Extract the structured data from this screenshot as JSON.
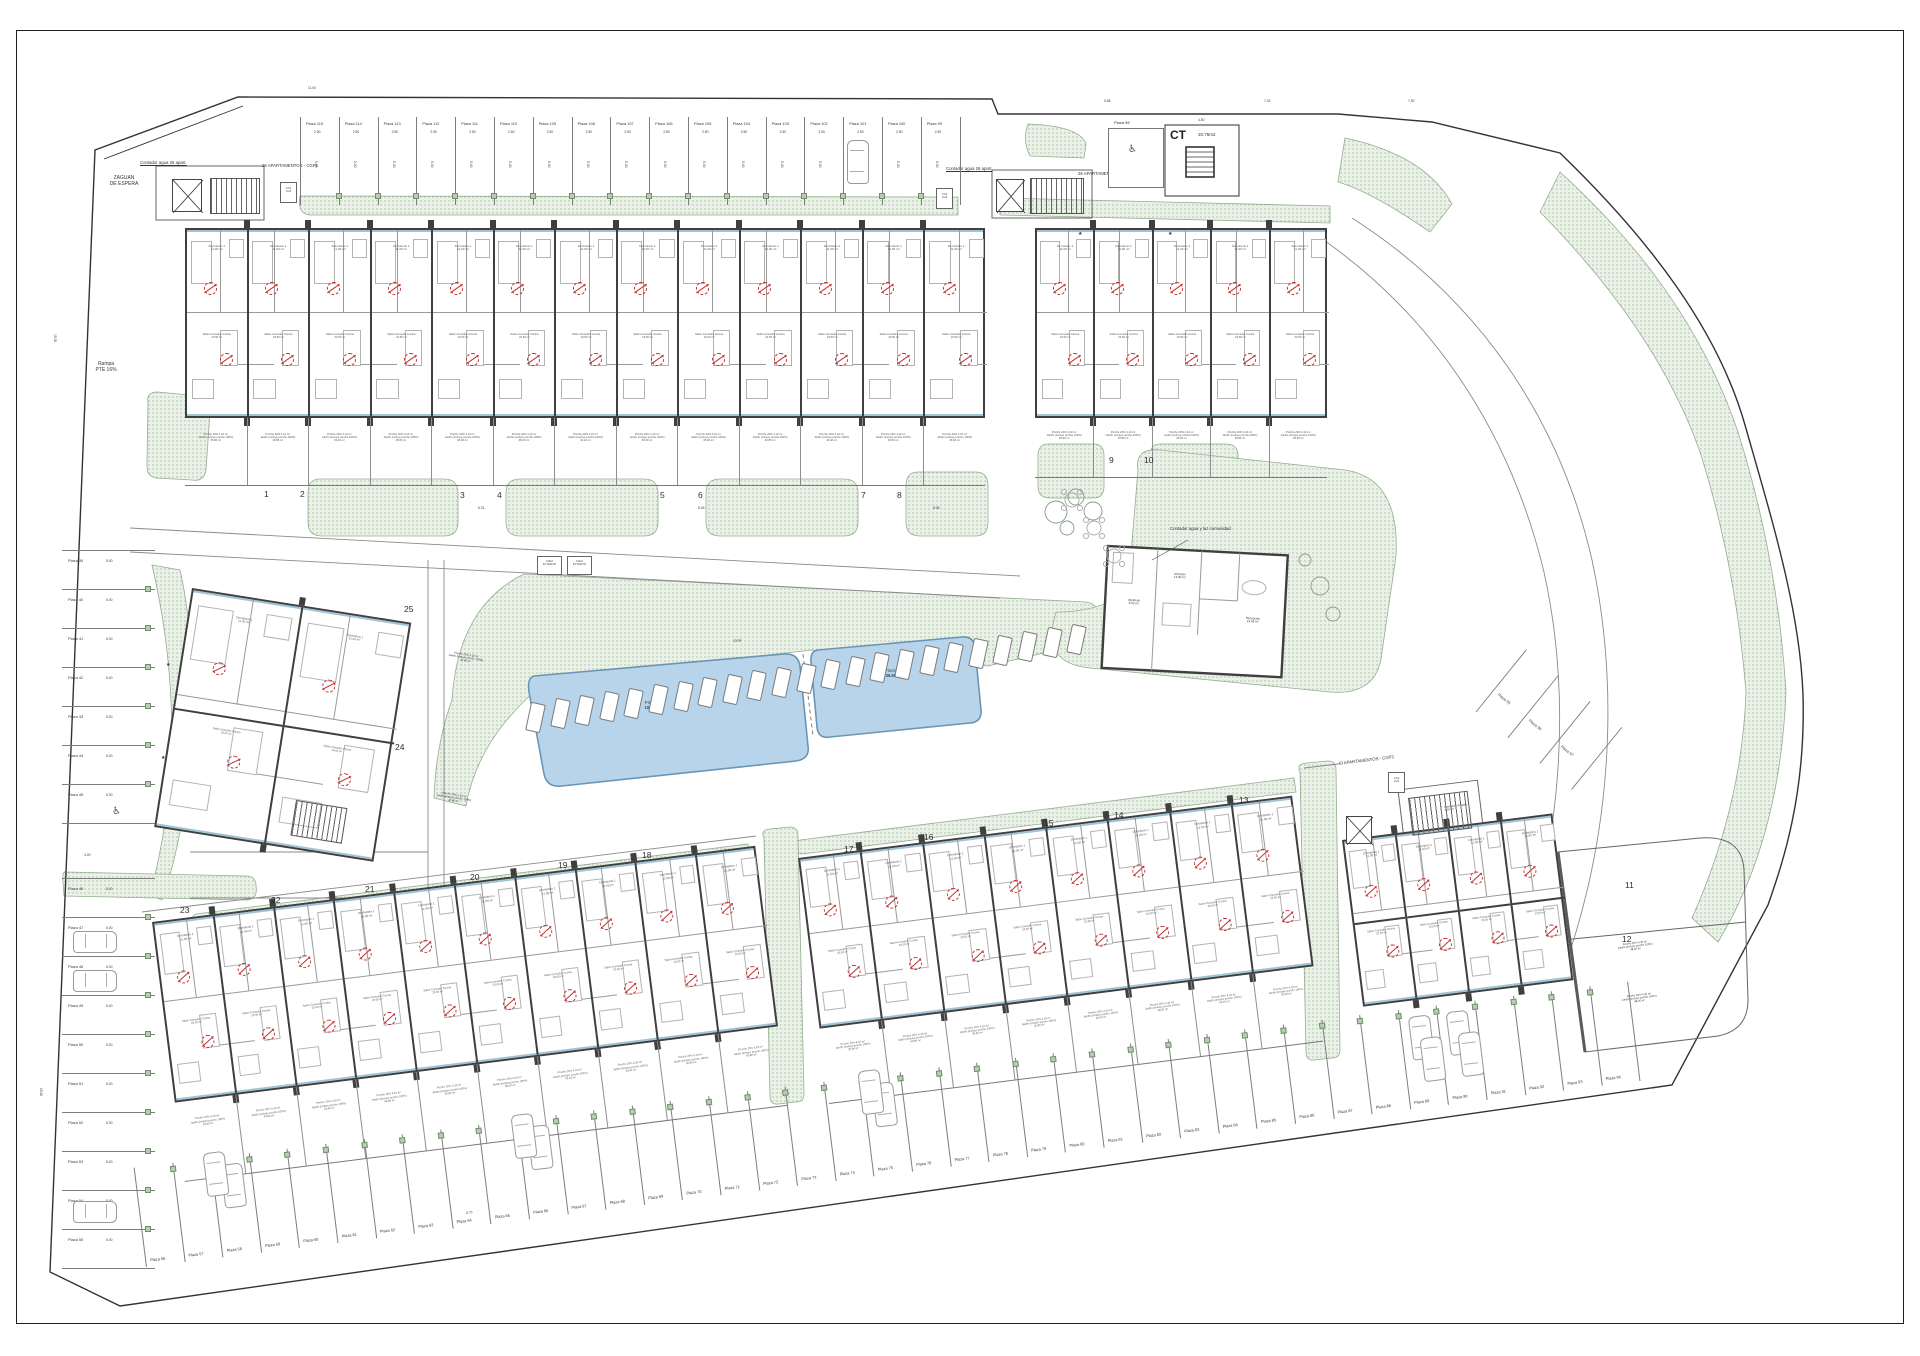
{
  "texts": {
    "zaguan": "ZAGUAN\nDE ESPERA",
    "rampa": "Rampa\nPTE 16%",
    "contador26_left": "Contador agua 26 apart.",
    "cgp1": "26 APARTAMENTOS - CGP1",
    "contador26_right": "Contador agua 26 apart.",
    "cgp2": "26 APARTAMENTOS - CGP2",
    "cgp3": "40 APARTAMENTOS - CGP3",
    "contador75": "Contador agua 75 apart.",
    "contador_comunidad": "Contador agua y luz comunidad",
    "contador75_room": "Contador 75 apart.\n3.00 m²",
    "ct": "CT",
    "ct_area": "20.75m2",
    "cc1": "CC1\nLUZ",
    "cc2": "CC2\nLUZ",
    "cc3": "CC3\nLUZ",
    "aseo": "ASEO\nEXTERIOR",
    "plaza98": "Plaza 98",
    "plaza98_dim": "3.81"
  },
  "pools": [
    {
      "name": "Piscina 1",
      "area": "100.30 m²"
    },
    {
      "name": "Piscina 2",
      "area": "36.90 m²"
    }
  ],
  "rooms": {
    "dorm1": "Dormitorio 1\n11.00 m²",
    "dorm2": "Dormitorio 2\n10.70 m²",
    "dorm3": "Dormitorio 3\n8.00 m²",
    "paso": "Paso\n4.60 m²",
    "bano1": "Baño 1\n3.90 m²",
    "bano2": "Baño 2\n3.00 m²",
    "salon": "Salón-Comedor-Cocina\n23.50 m²"
  },
  "community_rooms": [
    "Vestíbulo\n8.50 m²",
    "Almacén\n13.80 m²",
    "Recepción\n23.65 m²"
  ],
  "garden": {
    "porche": "Porche 20% 4.10 m²",
    "jardin": "Jardín (incluye porche 100%)",
    "areas": [
      "35.90 m²",
      "40.85 m²",
      "43.40 m²",
      "45.80 m²",
      "36.90 m²",
      "48.20 m²",
      "42.10 m²",
      "39.60 m²"
    ]
  },
  "parking": {
    "stall_width_dim": "2.50",
    "stall_depth_dim": "5.00",
    "top": [
      "Plaza 115",
      "Plaza 114",
      "Plaza 113",
      "Plaza 112",
      "Plaza 111",
      "Plaza 110",
      "Plaza 109",
      "Plaza 108",
      "Plaza 107",
      "Plaza 106",
      "Plaza 105",
      "Plaza 104",
      "Plaza 103",
      "Plaza 102",
      "Plaza 101",
      "Plaza 100",
      "Plaza 99"
    ],
    "left": [
      "Plaza 39",
      "Plaza 40",
      "Plaza 41",
      "Plaza 42",
      "Plaza 43",
      "Plaza 44",
      "Plaza 45",
      "Plaza 46",
      "Plaza 47",
      "Plaza 48",
      "Plaza 49",
      "Plaza 50",
      "Plaza 51",
      "Plaza 52",
      "Plaza 53",
      "Plaza 54",
      "Plaza 55"
    ],
    "bottom": [
      "Plaza 56",
      "Plaza 57",
      "Plaza 58",
      "Plaza 59",
      "Plaza 60",
      "Plaza 61",
      "Plaza 62",
      "Plaza 63",
      "Plaza 64",
      "Plaza 65",
      "Plaza 66",
      "Plaza 67",
      "Plaza 68",
      "Plaza 69",
      "Plaza 70",
      "Plaza 71",
      "Plaza 72",
      "Plaza 73",
      "Plaza 74",
      "Plaza 75",
      "Plaza 76",
      "Plaza 77",
      "Plaza 78",
      "Plaza 79",
      "Plaza 80",
      "Plaza 81",
      "Plaza 82",
      "Plaza 83",
      "Plaza 84",
      "Plaza 85",
      "Plaza 86",
      "Plaza 87",
      "Plaza 88",
      "Plaza 89",
      "Plaza 90",
      "Plaza 91",
      "Plaza 92",
      "Plaza 93",
      "Plaza 94"
    ],
    "diagonal": [
      "Plaza 95",
      "Plaza 96",
      "Plaza 97"
    ]
  },
  "block_numbers": [
    {
      "n": "1",
      "x": 264,
      "y": 489
    },
    {
      "n": "2",
      "x": 300,
      "y": 489
    },
    {
      "n": "3",
      "x": 460,
      "y": 490
    },
    {
      "n": "4",
      "x": 497,
      "y": 490
    },
    {
      "n": "5",
      "x": 660,
      "y": 490
    },
    {
      "n": "6",
      "x": 698,
      "y": 490
    },
    {
      "n": "7",
      "x": 861,
      "y": 490
    },
    {
      "n": "8",
      "x": 897,
      "y": 490
    },
    {
      "n": "9",
      "x": 1109,
      "y": 455
    },
    {
      "n": "10",
      "x": 1144,
      "y": 455
    },
    {
      "n": "11",
      "x": 1625,
      "y": 880
    },
    {
      "n": "12",
      "x": 1622,
      "y": 934
    },
    {
      "n": "13",
      "x": 1239,
      "y": 795
    },
    {
      "n": "14",
      "x": 1114,
      "y": 810
    },
    {
      "n": "15",
      "x": 1044,
      "y": 818
    },
    {
      "n": "16",
      "x": 924,
      "y": 832
    },
    {
      "n": "17",
      "x": 844,
      "y": 844
    },
    {
      "n": "18",
      "x": 642,
      "y": 850
    },
    {
      "n": "19",
      "x": 558,
      "y": 860
    },
    {
      "n": "20",
      "x": 470,
      "y": 872
    },
    {
      "n": "21",
      "x": 365,
      "y": 884
    },
    {
      "n": "22",
      "x": 271,
      "y": 895
    },
    {
      "n": "23",
      "x": 180,
      "y": 905
    },
    {
      "n": "24",
      "x": 395,
      "y": 742
    },
    {
      "n": "25",
      "x": 404,
      "y": 604
    }
  ],
  "blocks": [
    {
      "id": "cgp1-block",
      "x": 185,
      "y": 228,
      "w": 800,
      "h": 190,
      "rot": 0,
      "units": 13,
      "garden": 68
    },
    {
      "id": "cgp2-block",
      "x": 1035,
      "y": 228,
      "w": 292,
      "h": 190,
      "rot": 0,
      "units": 5,
      "garden": 60
    },
    {
      "id": "block-24-25",
      "x": 192,
      "y": 588,
      "w": 222,
      "h": 242,
      "rot": 9,
      "units": 2,
      "rows": 2,
      "garden": 0
    },
    {
      "id": "block-18-23",
      "x": 152,
      "y": 922,
      "w": 608,
      "h": 182,
      "rot": -7.2,
      "units": 10,
      "garden": 80
    },
    {
      "id": "block-13-17",
      "x": 798,
      "y": 858,
      "w": 498,
      "h": 172,
      "rot": -7.2,
      "units": 8,
      "garden": 76
    },
    {
      "id": "cgp3-block",
      "x": 1342,
      "y": 840,
      "w": 212,
      "h": 168,
      "rot": -7.2,
      "units": 4,
      "rows": 2,
      "garden": 0
    }
  ],
  "garden_extra_labels": [
    {
      "x": 432,
      "y": 648,
      "r": 9,
      "a": 4
    },
    {
      "x": 420,
      "y": 788,
      "r": 9,
      "a": 0
    },
    {
      "x": 1600,
      "y": 946,
      "r": -7,
      "a": 5
    },
    {
      "x": 1604,
      "y": 998,
      "r": -7,
      "a": 5
    }
  ],
  "dims": [
    {
      "t": "11.00",
      "x": 308,
      "y": 86,
      "r": 0
    },
    {
      "t": "5.88",
      "x": 1104,
      "y": 99,
      "r": 0
    },
    {
      "t": "7.02",
      "x": 1264,
      "y": 99,
      "r": 0
    },
    {
      "t": "7.50",
      "x": 1408,
      "y": 99,
      "r": 0
    },
    {
      "t": "4.80",
      "x": 1198,
      "y": 118,
      "r": 0
    },
    {
      "t": "6.31",
      "x": 478,
      "y": 506,
      "r": 0
    },
    {
      "t": "8.45",
      "x": 698,
      "y": 506,
      "r": 0
    },
    {
      "t": "8.06",
      "x": 933,
      "y": 506,
      "r": 0
    },
    {
      "t": "23.96",
      "x": 733,
      "y": 639,
      "r": -4
    },
    {
      "t": "6.75",
      "x": 466,
      "y": 1211,
      "r": -7
    },
    {
      "t": "4.00",
      "x": 84,
      "y": 853,
      "r": 0
    },
    {
      "t": "15.30",
      "x": 57,
      "y": 334,
      "r": 90
    },
    {
      "t": "25.60",
      "x": 43,
      "y": 1088,
      "r": 90
    }
  ],
  "stars": [
    [
      1078,
      231
    ],
    [
      1168,
      231
    ],
    [
      166,
      662
    ],
    [
      161,
      755
    ]
  ],
  "cars": [
    {
      "x": 847,
      "y": 140,
      "r": 0
    },
    {
      "x": 84,
      "y": 920,
      "r": 90
    },
    {
      "x": 84,
      "y": 959,
      "r": 90
    },
    {
      "x": 84,
      "y": 1190,
      "r": 90
    },
    {
      "x": 205,
      "y": 1152,
      "r": -7
    },
    {
      "x": 513,
      "y": 1114,
      "r": -7
    },
    {
      "x": 860,
      "y": 1070,
      "r": -7
    },
    {
      "x": 1422,
      "y": 1037,
      "r": -7
    },
    {
      "x": 1460,
      "y": 1032,
      "r": -7
    }
  ],
  "stairs": [
    {
      "x": 210,
      "y": 178,
      "w": 48,
      "h": 34,
      "r": 0
    },
    {
      "x": 1030,
      "y": 178,
      "w": 52,
      "h": 34,
      "r": 0
    },
    {
      "x": 1408,
      "y": 798,
      "w": 58,
      "h": 36,
      "r": -7
    },
    {
      "x": 296,
      "y": 800,
      "w": 50,
      "h": 34,
      "r": 9
    }
  ],
  "elevators": [
    {
      "x": 172,
      "y": 179,
      "w": 30,
      "h": 33
    },
    {
      "x": 996,
      "y": 179,
      "w": 28,
      "h": 33
    },
    {
      "x": 1346,
      "y": 816,
      "w": 26,
      "h": 28
    }
  ],
  "ccboxes": [
    {
      "x": 280,
      "y": 182,
      "bind": "cc1"
    },
    {
      "x": 936,
      "y": 188,
      "bind": "cc2"
    },
    {
      "x": 1388,
      "y": 772,
      "bind": "cc3"
    }
  ],
  "loungers": {
    "x0": 528,
    "y0": 703,
    "n": 23,
    "dx": 24.6,
    "dy": -3.55,
    "rot": 12
  },
  "trees": [
    [
      1056,
      512,
      11
    ],
    [
      1076,
      497,
      8
    ],
    [
      1093,
      511,
      9
    ],
    [
      1067,
      528,
      7
    ],
    [
      1305,
      560,
      6
    ],
    [
      1320,
      586,
      9
    ],
    [
      1333,
      614,
      7
    ]
  ],
  "tables": [
    [
      1072,
      500
    ],
    [
      1094,
      528
    ],
    [
      1114,
      556
    ]
  ],
  "colors": {
    "wall": "#3f3f3f",
    "partition": "#9a9a9a",
    "green_fill": "#eaf1e7",
    "green_dot": "#a5bda0",
    "green_edge": "#94ad90",
    "pool_fill": "#b8d4ea",
    "pool_edge": "#6b95b5",
    "glass": "#9fc4d8",
    "marker_red": "#c03030",
    "line": "#7d7d7d"
  }
}
